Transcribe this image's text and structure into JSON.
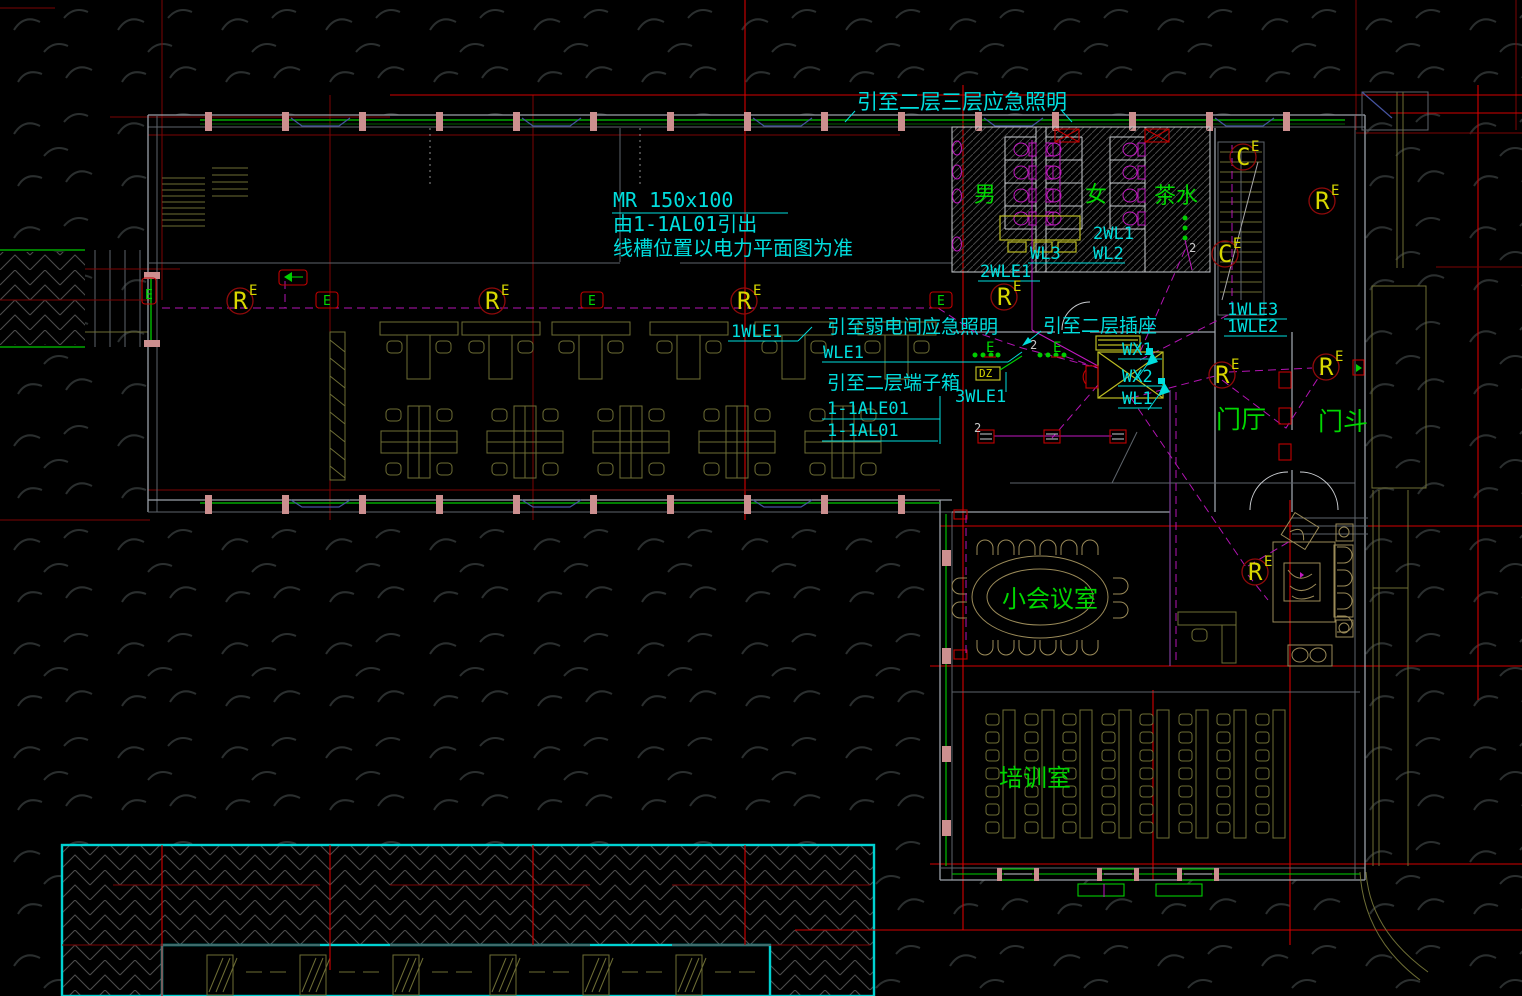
{
  "annotations": {
    "top_note": "引至二层三层应急照明",
    "tray_size": "MR 150x100",
    "tray_from": "由1-1AL01引出",
    "tray_note": "线槽位置以电力平面图为准",
    "weak_room_note": "引至弱电间应急照明",
    "terminal_box_note": "引至二层端子箱",
    "socket_note": "引至二层插座"
  },
  "rooms": {
    "male_wc": "男",
    "female_wc": "女",
    "tea_room": "茶水",
    "lobby": "门厅",
    "vestibule": "门斗",
    "meeting_room": "小会议室",
    "training_room": "培训室"
  },
  "circuits": {
    "wl3": "WL3",
    "two_wl1": "2WL1",
    "wl2": "WL2",
    "two_wle1": "2WLE1",
    "one_wle1": "1WLE1",
    "wle1": "WLE1",
    "three_wle1": "3WLE1",
    "wx1": "WX1",
    "wx2": "WX2",
    "wl1": "WL1",
    "one_wle3": "1WLE3",
    "one_wle2": "1WLE2",
    "panel_ale": "1-1ALE01",
    "panel_al": "1-1AL01",
    "dz": "DZ"
  },
  "symbols": {
    "r": "R",
    "c": "C",
    "e": "E",
    "two": "2"
  },
  "colors": {
    "annotation_cyan": "#00dede",
    "room_label_green": "#00d800",
    "marker_yellow": "#d8d800",
    "grid_red": "#d40000",
    "wiring_magenta": "#b414b4",
    "furniture_olive": "#6e6e35",
    "wall_gray": "#9aa0a8",
    "window_green": "#00a800",
    "sill_blue": "#4654a0",
    "stud_pink": "#cc8f8f",
    "structure_cyan": "#00d2d2"
  }
}
